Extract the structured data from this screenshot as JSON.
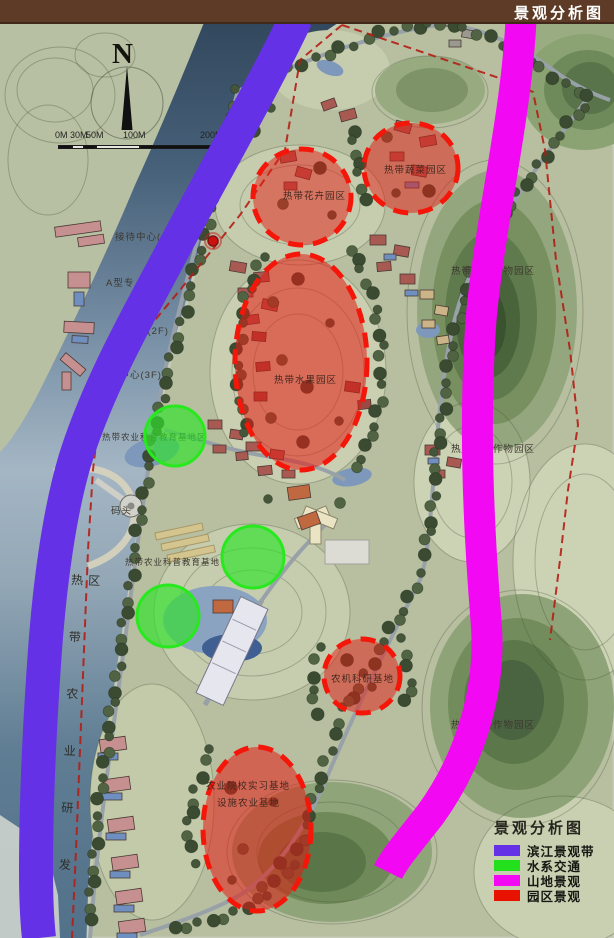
{
  "header": {
    "title": "景观分析图"
  },
  "compass": {
    "n": "N"
  },
  "scalebar": {
    "ticks": [
      "0M",
      "30M",
      "50M",
      "100M",
      "200M"
    ]
  },
  "labels": {
    "reception": "接待中心(",
    "atype": "A型专",
    "building2f": "楼(2F)",
    "service3f": "务中心(3F)",
    "flower": "热带花卉园区",
    "vegetable": "热带蔬菜园区",
    "fruit": "热带水果园区",
    "edu1": "热带农业科普教育基地区",
    "edu2": "热带农业科普教育基地",
    "pier": "码头",
    "machinery": "农机科研基地",
    "college": "农业院校实习基地",
    "facility": "设施农业基地",
    "cash1": "热带经济作物园区",
    "cash2": "热带经济作物园区",
    "cash3": "热带经济作物园区",
    "rnd_vertical": "热带农业研发区"
  },
  "legend": {
    "title": "景观分析图",
    "items": [
      {
        "label": "滨江景观带",
        "color": "#6531e6"
      },
      {
        "label": "水系交通",
        "color": "#22e01c"
      },
      {
        "label": "山地景观",
        "color": "#f308f3"
      },
      {
        "label": "园区景观",
        "color": "#e81200"
      }
    ]
  }
}
